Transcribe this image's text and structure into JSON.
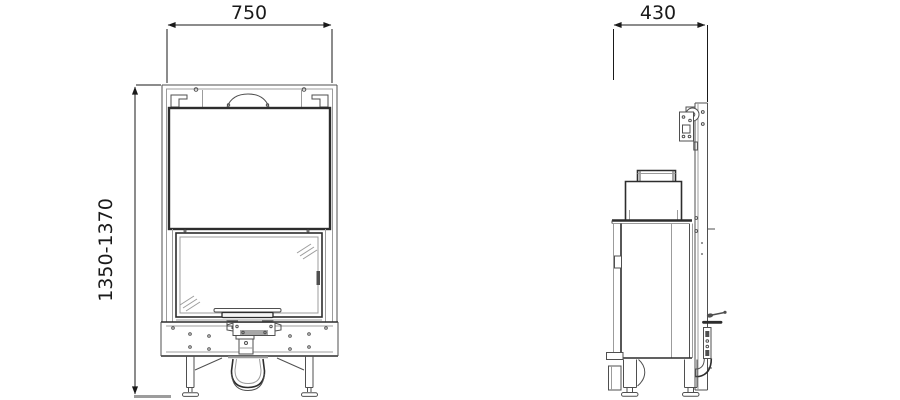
{
  "drawing": {
    "front_view": {
      "width_mm": "750",
      "height_range_mm": "1350-1370"
    },
    "side_view": {
      "depth_mm": "430"
    }
  },
  "colors": {
    "background": "#ffffff",
    "text": "#1a1a1a",
    "dark": "#2d2d2d",
    "line": "#4f4f4f",
    "light": "#9c9c9c"
  }
}
